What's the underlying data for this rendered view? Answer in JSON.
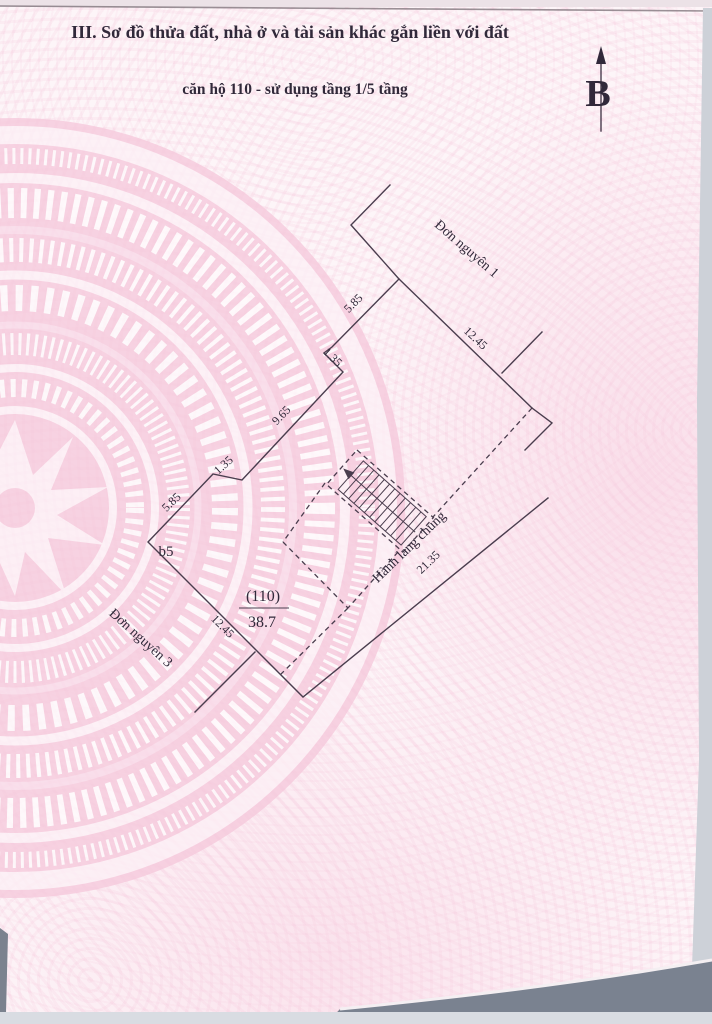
{
  "page": {
    "title": "III. Sơ đồ thửa đất, nhà ở và tài sản khác gắn liền với đất",
    "subtitle": "căn hộ 110 - sử dụng tầng 1/5 tầng"
  },
  "compass": {
    "north_label": "B"
  },
  "plan": {
    "section_labels": {
      "unit1": "Đơn nguyên 1",
      "unit3": "Đơn nguyên 3",
      "corridor": "Hành lang chung",
      "point_b5": "b5"
    },
    "apartment": {
      "number": "(110)",
      "area": "38.7"
    },
    "dimensions": {
      "top_585": "5.85",
      "top_1245": "12.45",
      "notch_135_top": "1.35",
      "mid_965": "9.65",
      "notch_135_bottom": "1.35",
      "bottom_585": "5.85",
      "bottom_1245": "12.45",
      "corridor_2135": "21.35"
    },
    "colors": {
      "line": "#4a3d4e",
      "paper_pink": "#fdf5f8",
      "drum_pink": "#f6c9dc",
      "edge_gray": "#7a8290"
    }
  }
}
